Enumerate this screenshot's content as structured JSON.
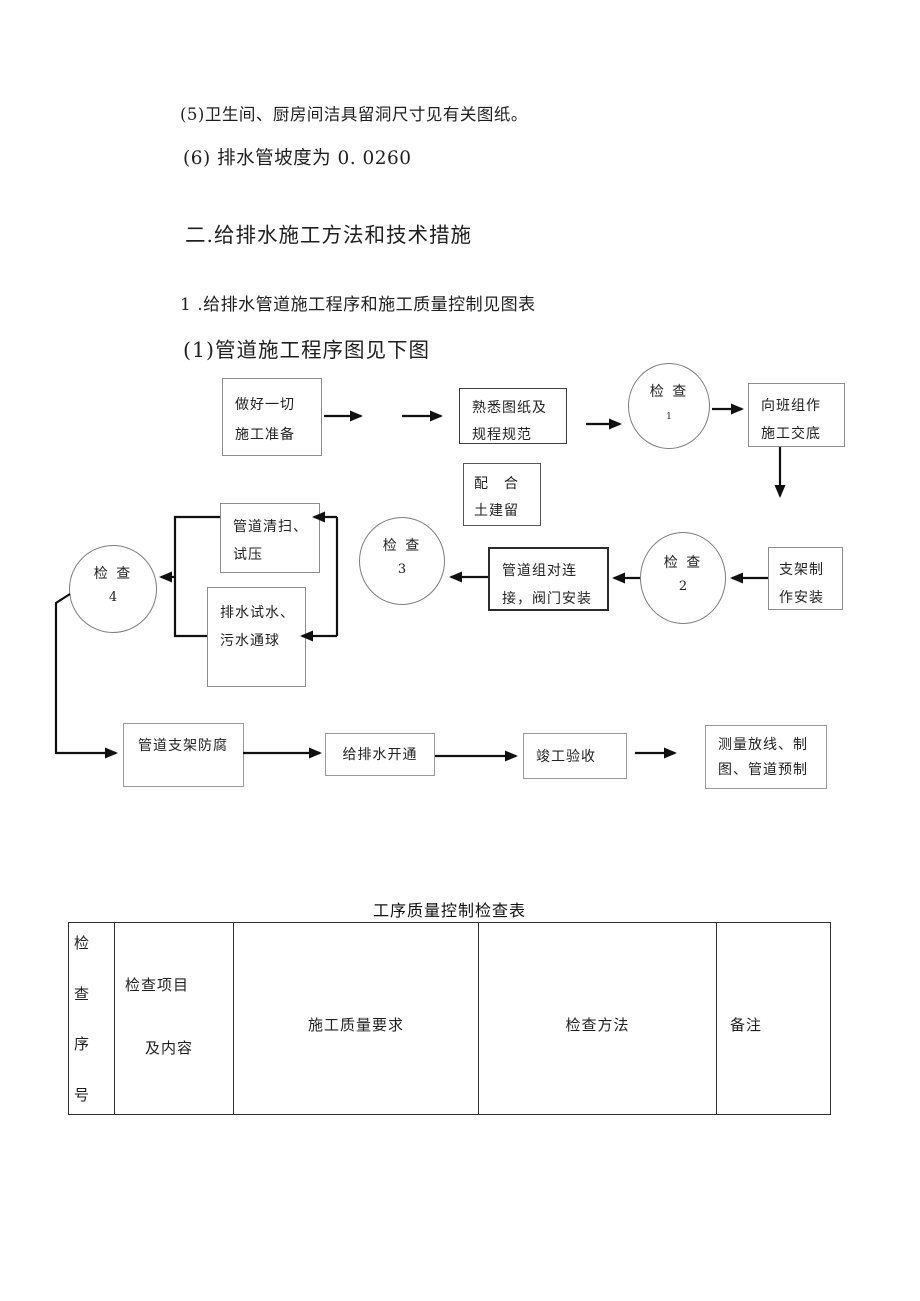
{
  "document": {
    "item5": "(5)卫生间、厨房间洁具留洞尺寸见有关图纸。",
    "item6": "(6) 排水管坡度为 0. 0260",
    "section_heading": "二.给排水施工方法和技术措施",
    "sub_heading": "1 .给排水管道施工程序和施工质量控制见图表",
    "figure_heading": "(1)管道施工程序图见下图"
  },
  "flowchart": {
    "prepare": {
      "line1": "做好一切",
      "line2": "施工准备"
    },
    "study_drawings": {
      "line1": "熟悉图纸及",
      "line2": "规程规范"
    },
    "check1": {
      "line1": "检 查",
      "line2": "1"
    },
    "team_briefing": {
      "line1": "向班组作",
      "line2": "施工交底"
    },
    "civil_reserve": {
      "line1": "配　合",
      "line2": "土建留"
    },
    "support_fabrication": {
      "line1": "支架制",
      "line2": "作安装"
    },
    "check2": {
      "line1": "检 查",
      "line2": "2"
    },
    "pipe_assembly": {
      "line1": "管道组对连",
      "line2": "接，阀门安装"
    },
    "check3": {
      "line1": "检 查",
      "line2": "3"
    },
    "pipe_cleaning": {
      "line1": "管道清扫、",
      "line2": "试压"
    },
    "drain_test": {
      "line1": "排水试水、",
      "line2": "污水通球"
    },
    "check4": {
      "line1": "检 查",
      "line2": "4"
    },
    "support_anticorrosion": {
      "line1": "管道支架防腐"
    },
    "water_opening": {
      "line1": "给排水开通"
    },
    "completion_acceptance": {
      "line1": "竣工验收"
    },
    "survey_prefab": {
      "line1": "测量放线、制",
      "line2": "图、管道预制"
    }
  },
  "table": {
    "title": "工序质量控制检查表",
    "col1_chars": [
      "检",
      "查",
      "序",
      "号"
    ],
    "col2": {
      "line1": "检查项目",
      "line2": "及内容"
    },
    "col3": "施工质量要求",
    "col4": "检查方法",
    "col5": "备注"
  },
  "colors": {
    "ink": "#1f1f1f",
    "box_border": "#8c8c8c",
    "table_border": "#2f2f2f",
    "arrow": "#101010"
  }
}
